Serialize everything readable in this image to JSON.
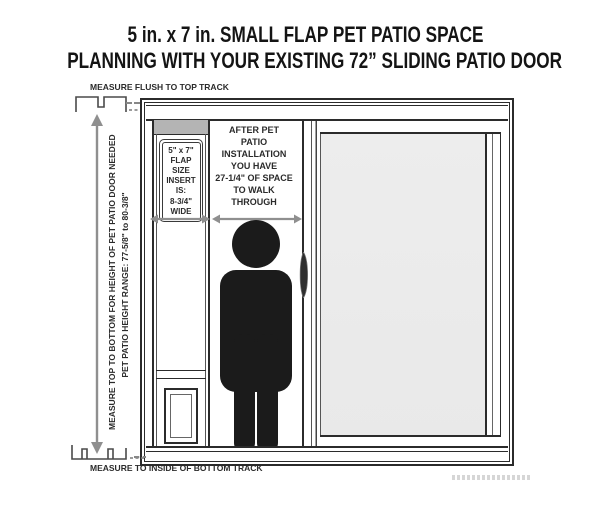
{
  "title": {
    "line1": "5 in. x 7 in. SMALL FLAP PET PATIO SPACE",
    "line2": "PLANNING WITH YOUR EXISTING 72” SLIDING PATIO DOOR"
  },
  "measurements": {
    "top_track": "MEASURE FLUSH TO TOP TRACK",
    "bottom_track": "MEASURE TO INSIDE OF BOTTOM TRACK",
    "height_needed": "MEASURE TOP TO BOTTOM FOR HEIGHT OF PET PATIO DOOR NEEDED",
    "height_range": "PET PATIO HEIGHT RANGE: 77-5/8\" to 80-3/8\""
  },
  "flap_panel": {
    "lines": [
      "5\" x 7\"",
      "FLAP",
      "SIZE",
      "INSERT",
      "IS:",
      "8-3/4\"",
      "WIDE"
    ]
  },
  "walkway": {
    "lines": [
      "AFTER PET",
      "PATIO",
      "INSTALLATION",
      "YOU HAVE",
      "27-1/4\" OF SPACE",
      "TO WALK",
      "THROUGH"
    ]
  },
  "colors": {
    "line": "#2b2b2b",
    "title": "#141414",
    "arrow": "#8f8f8f",
    "glass": "#e9e9e9",
    "header": "#b4b4b4",
    "figure": "#1b1b1b"
  }
}
